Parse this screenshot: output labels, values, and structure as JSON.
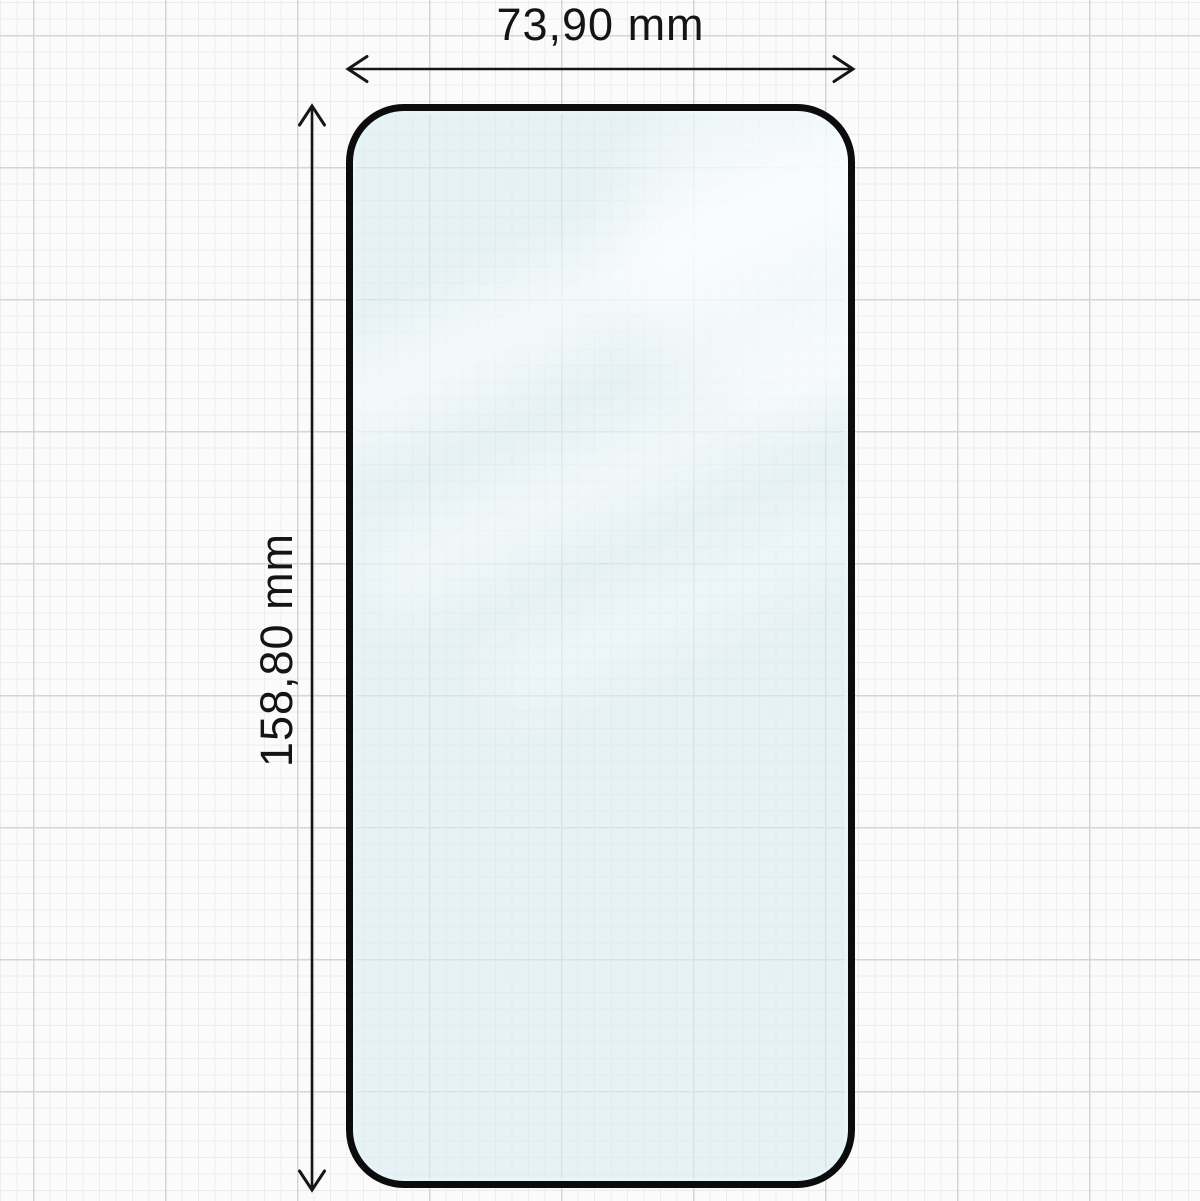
{
  "diagram": {
    "type": "product-dimension-diagram",
    "subject": "tempered-glass-screen-protector-outline",
    "width_dimension": {
      "label": "73,90 mm",
      "value_mm": 73.9
    },
    "height_dimension": {
      "label": "158,80 mm",
      "value_mm": 158.8
    },
    "colors": {
      "background": "#fbfbfb",
      "grid_minor": "#ececee",
      "grid_major": "#d3d6d8",
      "glass_outline": "#0c0c0c",
      "glass_tint": "#e9f2f5",
      "dimension_lines": "#161616",
      "label_text": "#141414"
    }
  }
}
